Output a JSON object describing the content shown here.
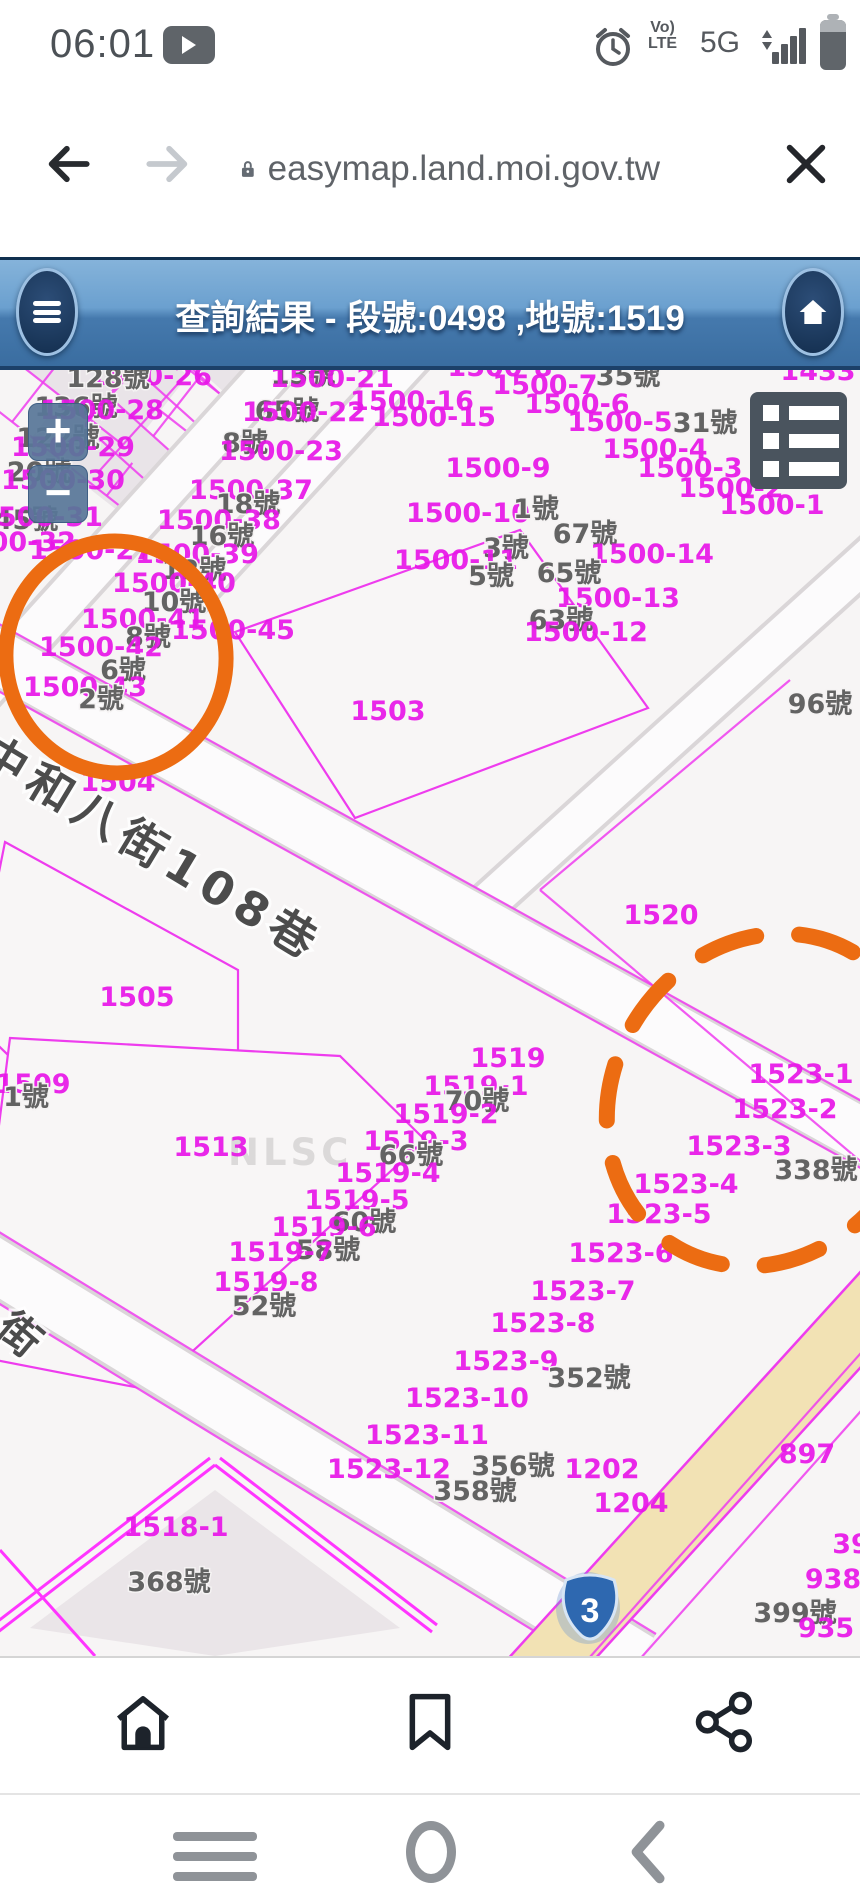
{
  "status_bar": {
    "time": "06:01",
    "network": "5G",
    "volte_line1": "Vo)",
    "volte_line2": "LTE"
  },
  "browser": {
    "url": "easymap.land.moi.gov.tw"
  },
  "header": {
    "title": "查詢結果 - 段號:0498 ,地號:1519"
  },
  "map": {
    "controls": {
      "zoom_in": "+",
      "zoom_out": "−"
    },
    "watermark": "NLSC",
    "highway_shield": {
      "number": "3"
    },
    "street_labels": [
      {
        "t": "中和八街108巷"
      },
      {
        "t": "街"
      }
    ],
    "colors": {
      "parcel_line": "#ee3cee",
      "parcel_label": "#e816e8",
      "house_label": "#636363",
      "annotation_orange": "#ec6c12",
      "highlight_parcel": "#e3a2a2",
      "road_yellow": "#f2e2b4",
      "header_blue": "#4579ad"
    },
    "labels": [
      [
        "1500-26",
        150,
        15,
        "m"
      ],
      [
        "128號",
        108,
        17,
        "g"
      ],
      [
        "13號",
        303,
        14,
        "g"
      ],
      [
        "1500-21",
        332,
        17,
        "m"
      ],
      [
        "1500-8",
        500,
        6,
        "m"
      ],
      [
        "1433",
        818,
        10,
        "m"
      ],
      [
        "1500-7",
        545,
        24,
        "m"
      ],
      [
        "35號",
        628,
        15,
        "g"
      ],
      [
        "1500-16",
        412,
        40,
        "m"
      ],
      [
        "1500-15",
        434,
        56,
        "m"
      ],
      [
        "1500-6",
        577,
        43,
        "m"
      ],
      [
        "136號",
        76,
        46,
        "g"
      ],
      [
        "1500-28",
        102,
        49,
        "m"
      ],
      [
        "65號",
        287,
        50,
        "g"
      ],
      [
        "1500-22",
        304,
        51,
        "m"
      ],
      [
        "1500-5",
        620,
        61,
        "m"
      ],
      [
        "31號",
        705,
        62,
        "g"
      ],
      [
        "122號",
        58,
        77,
        "g"
      ],
      [
        "1500-29",
        73,
        86,
        "m"
      ],
      [
        "8號",
        245,
        82,
        "g"
      ],
      [
        "1500-23",
        281,
        90,
        "m"
      ],
      [
        "1500-4",
        655,
        88,
        "m"
      ],
      [
        "1500-9",
        498,
        107,
        "m"
      ],
      [
        "1500-3",
        690,
        107,
        "m"
      ],
      [
        "20號",
        39,
        111,
        "g"
      ],
      [
        "1500-30",
        63,
        119,
        "m"
      ],
      [
        "1500-2",
        731,
        127,
        "m"
      ],
      [
        "1500-37",
        251,
        129,
        "m"
      ],
      [
        "18號",
        248,
        143,
        "g"
      ],
      [
        "1500-1",
        772,
        144,
        "m"
      ],
      [
        "1500-10",
        468,
        152,
        "m"
      ],
      [
        "1號",
        536,
        148,
        "g"
      ],
      [
        "45號",
        26,
        159,
        "g"
      ],
      [
        "1500-31",
        41,
        156,
        "m"
      ],
      [
        "1500-38",
        219,
        159,
        "m"
      ],
      [
        "16號",
        222,
        175,
        "g"
      ],
      [
        "67號",
        585,
        173,
        "g"
      ],
      [
        "3號",
        506,
        187,
        "g"
      ],
      [
        "1500-32",
        14,
        181,
        "m"
      ],
      [
        "1500-27",
        91,
        189,
        "m"
      ],
      [
        "1500-39",
        197,
        193,
        "m"
      ],
      [
        "1500-14",
        652,
        193,
        "m"
      ],
      [
        "1500-11",
        456,
        199,
        "m"
      ],
      [
        "12號",
        194,
        209,
        "g"
      ],
      [
        "65號",
        569,
        212,
        "g"
      ],
      [
        "5號",
        491,
        215,
        "g"
      ],
      [
        "1500-40",
        174,
        222,
        "m"
      ],
      [
        "10號",
        174,
        241,
        "g"
      ],
      [
        "1500-13",
        618,
        237,
        "m"
      ],
      [
        "63號",
        561,
        259,
        "g"
      ],
      [
        "1500-41",
        143,
        258,
        "m"
      ],
      [
        "1500-45",
        233,
        269,
        "m"
      ],
      [
        "8號",
        148,
        276,
        "g"
      ],
      [
        "1500-12",
        586,
        271,
        "m"
      ],
      [
        "1500-42",
        101,
        286,
        "m"
      ],
      [
        "6號",
        123,
        309,
        "g"
      ],
      [
        "1500-43",
        85,
        326,
        "m"
      ],
      [
        "2號",
        101,
        338,
        "g"
      ],
      [
        "96號",
        820,
        343,
        "g"
      ],
      [
        "1503",
        388,
        350,
        "m"
      ],
      [
        "1504",
        118,
        421,
        "m"
      ],
      [
        "1520",
        661,
        554,
        "m"
      ],
      [
        "1505",
        137,
        636,
        "m"
      ],
      [
        "1509",
        33,
        723,
        "m"
      ],
      [
        "1號",
        26,
        736,
        "g"
      ],
      [
        "1513",
        211,
        786,
        "m"
      ],
      [
        "1519",
        508,
        697,
        "m"
      ],
      [
        "1519-1",
        476,
        725,
        "m"
      ],
      [
        "70號",
        477,
        740,
        "g"
      ],
      [
        "1519-2",
        446,
        753,
        "m"
      ],
      [
        "1519-3",
        416,
        780,
        "m"
      ],
      [
        "66號",
        411,
        794,
        "g"
      ],
      [
        "1519-4",
        388,
        812,
        "m"
      ],
      [
        "1519-5",
        357,
        839,
        "m"
      ],
      [
        "60號",
        364,
        861,
        "g"
      ],
      [
        "1519-6",
        324,
        866,
        "m"
      ],
      [
        "58號",
        328,
        889,
        "g"
      ],
      [
        "1519-7",
        281,
        891,
        "m"
      ],
      [
        "1519-8",
        266,
        921,
        "m"
      ],
      [
        "52號",
        264,
        945,
        "g"
      ],
      [
        "1523-1",
        801,
        713,
        "m"
      ],
      [
        "1523-2",
        785,
        748,
        "m"
      ],
      [
        "1523-3",
        739,
        785,
        "m"
      ],
      [
        "338號",
        816,
        809,
        "g"
      ],
      [
        "1523-4",
        686,
        823,
        "m"
      ],
      [
        "1523-5",
        659,
        853,
        "m"
      ],
      [
        "1523-6",
        621,
        892,
        "m"
      ],
      [
        "1523-7",
        583,
        930,
        "m"
      ],
      [
        "1523-8",
        543,
        962,
        "m"
      ],
      [
        "1523-9",
        506,
        1000,
        "m"
      ],
      [
        "352號",
        589,
        1017,
        "g"
      ],
      [
        "1523-10",
        467,
        1037,
        "m"
      ],
      [
        "1523-11",
        427,
        1074,
        "m"
      ],
      [
        "1523-12",
        389,
        1108,
        "m"
      ],
      [
        "356號",
        513,
        1105,
        "g"
      ],
      [
        "358號",
        475,
        1130,
        "g"
      ],
      [
        "1202",
        602,
        1108,
        "m"
      ],
      [
        "1204",
        631,
        1142,
        "m"
      ],
      [
        "897",
        807,
        1093,
        "m"
      ],
      [
        "39",
        851,
        1183,
        "m"
      ],
      [
        "938",
        833,
        1218,
        "m"
      ],
      [
        "399號",
        795,
        1252,
        "g"
      ],
      [
        "935",
        826,
        1267,
        "m"
      ],
      [
        "1518-1",
        176,
        1166,
        "m"
      ],
      [
        "368號",
        169,
        1221,
        "g"
      ]
    ]
  },
  "footer": {
    "icons": [
      "home",
      "bookmark",
      "share"
    ]
  },
  "android_nav": {
    "icons": [
      "menu",
      "home-circle",
      "back"
    ]
  }
}
